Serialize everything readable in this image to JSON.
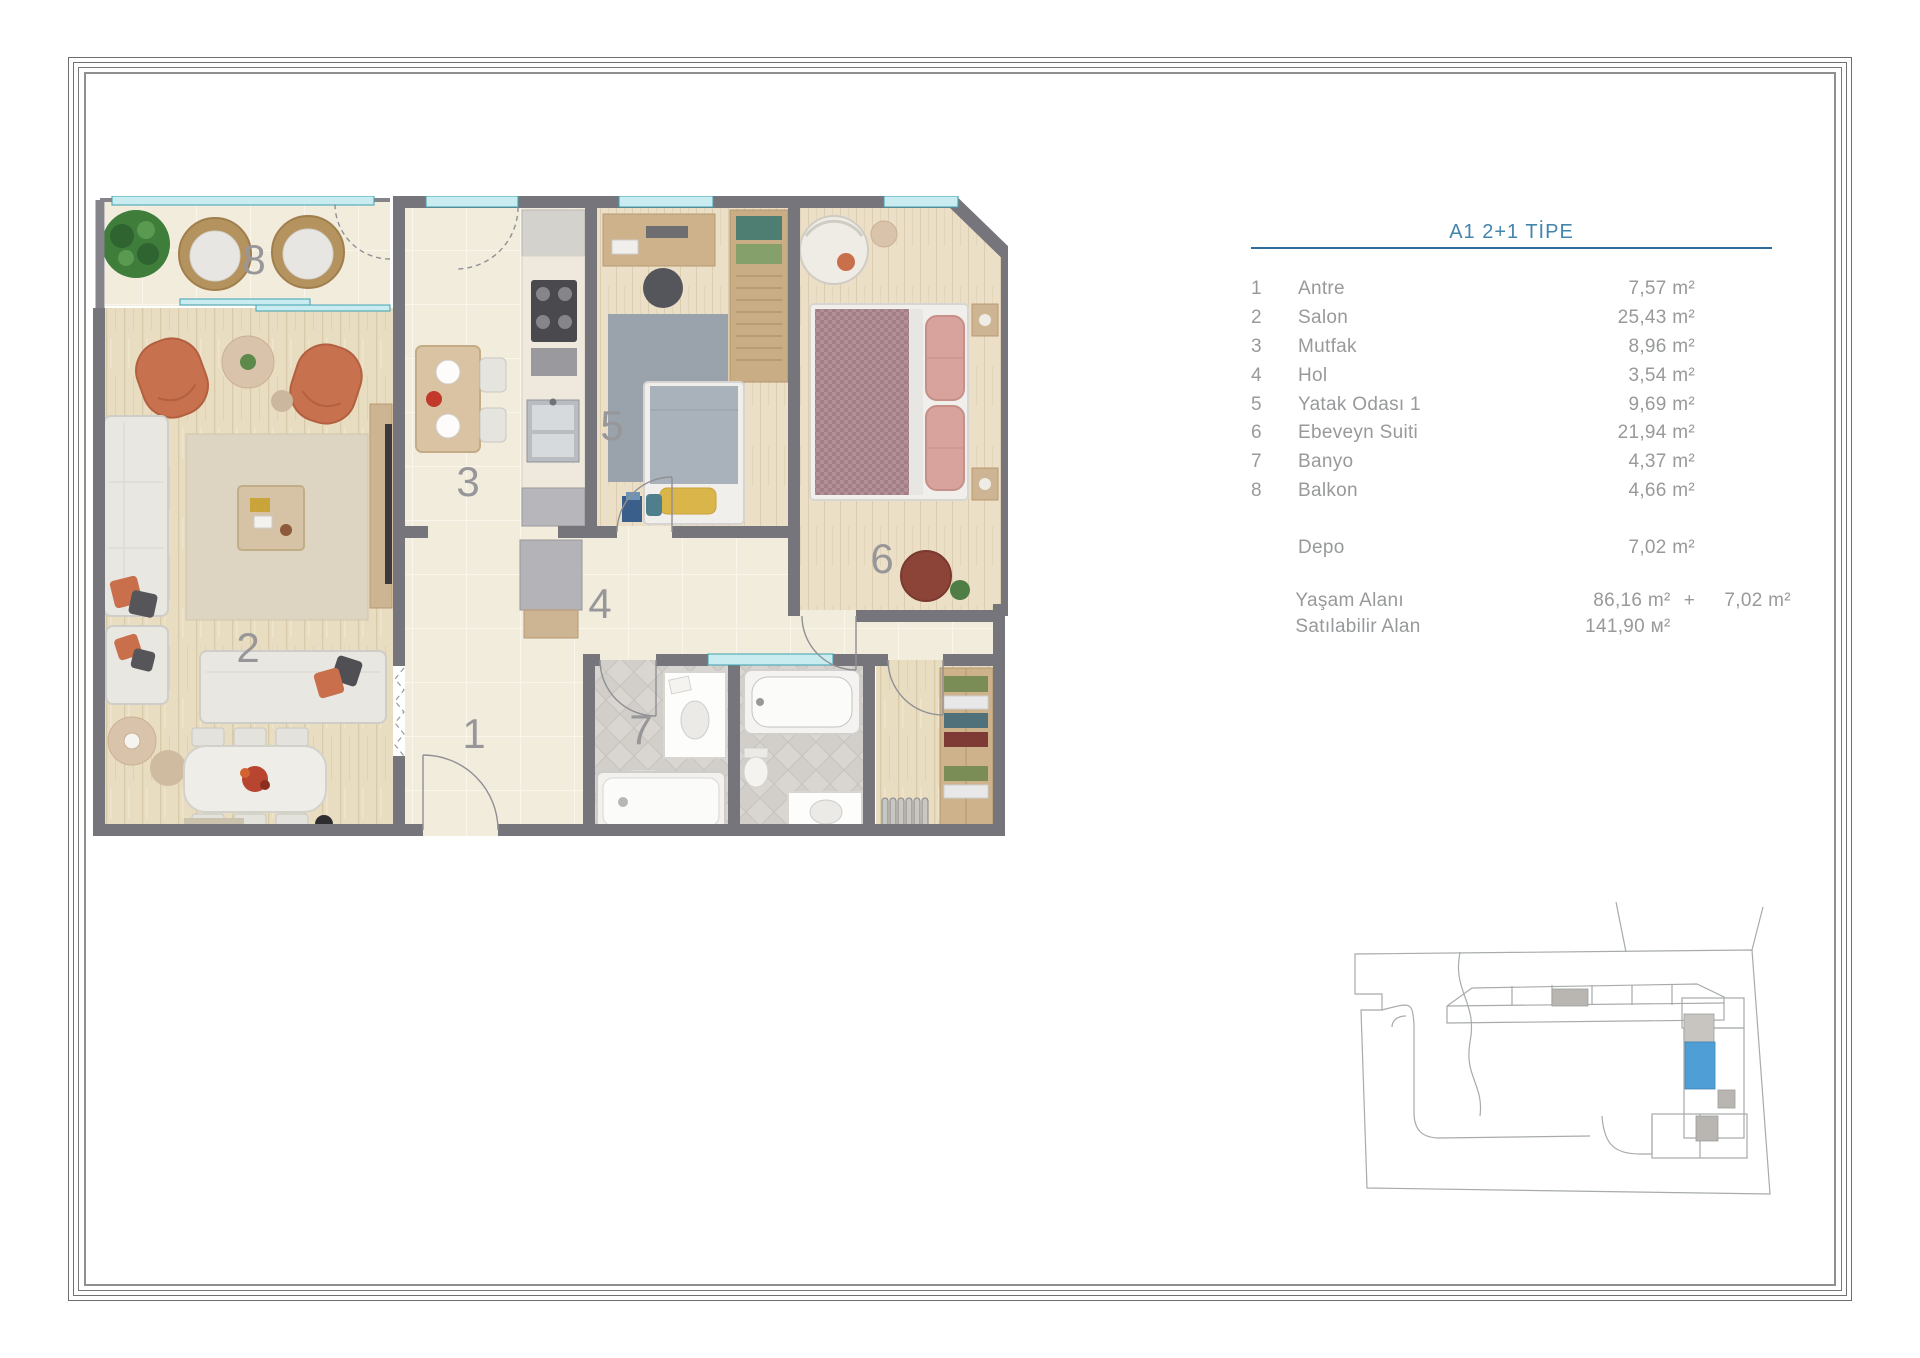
{
  "legend": {
    "title": "A1 2+1 TİPE",
    "rows": [
      {
        "num": "1",
        "label": "Antre",
        "area": "7,57 m²"
      },
      {
        "num": "2",
        "label": "Salon",
        "area": "25,43 m²"
      },
      {
        "num": "3",
        "label": "Mutfak",
        "area": "8,96 m²"
      },
      {
        "num": "4",
        "label": "Hol",
        "area": "3,54 m²"
      },
      {
        "num": "5",
        "label": "Yatak Odası 1",
        "area": "9,69 m²"
      },
      {
        "num": "6",
        "label": "Ebeveyn Suiti",
        "area": "21,94 m²"
      },
      {
        "num": "7",
        "label": "Banyo",
        "area": "4,37 m²"
      },
      {
        "num": "8",
        "label": "Balkon",
        "area": "4,66 m²"
      }
    ],
    "extra_row": {
      "label": "Depo",
      "area": "7,02 m²"
    },
    "totals": [
      {
        "label": "Yaşam Alanı",
        "value": "86,16 m²",
        "plus": "+",
        "value2": "7,02 m²"
      },
      {
        "label": "Satılabilir Alan",
        "value": "141,90 м²",
        "plus": "",
        "value2": ""
      }
    ]
  },
  "plan": {
    "rooms": {
      "antre": "1",
      "salon": "2",
      "mutfak": "3",
      "hol": "4",
      "yatak_odasi": "5",
      "ebeveyn": "6",
      "banyo": "7",
      "balkon": "8"
    }
  },
  "colors": {
    "title_blue": "#4285ad",
    "rule_blue": "#2b6d9d",
    "legend_text": "#97999b",
    "wall_gray": "#75757b",
    "tile_cream": "#f2ecdd",
    "wood_beige": "#e8dcc1",
    "window_glass": "#c9ecf1",
    "window_frame": "#3f9fae",
    "accent_orange": "#c7714f",
    "site_highlight_blue": "#4f9fd6"
  }
}
